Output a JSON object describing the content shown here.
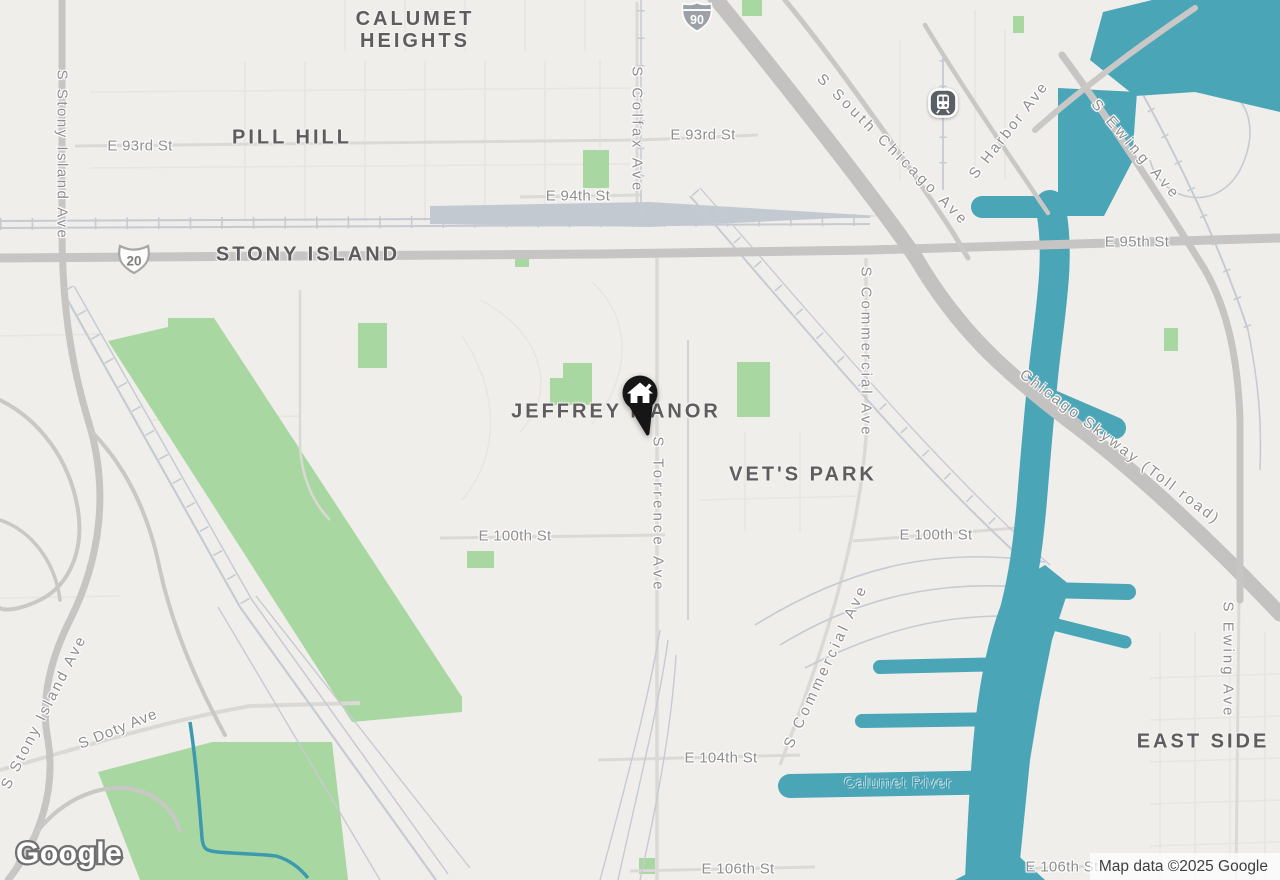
{
  "map": {
    "background_color": "#F0EEEB",
    "water_color": "#4AA5B7",
    "park_color": "#A9D7A2",
    "road_color": "#C6C5C3",
    "marker_color": "#161616"
  },
  "neighborhoods": {
    "calumet_heights_line1": "CALUMET",
    "calumet_heights_line2": "HEIGHTS",
    "pill_hill": "PILL HILL",
    "stony_island": "STONY ISLAND",
    "jeffrey_manor": "JEFFREY MANOR",
    "vets_park": "VET'S PARK",
    "east_side": "EAST SIDE"
  },
  "streets": {
    "e_93rd_west": "E 93rd St",
    "e_93rd_east": "E 93rd St",
    "e_94th": "E 94th St",
    "e_95th": "E 95th St",
    "e_100th_west": "E 100th St",
    "e_100th_east": "E 100th St",
    "e_104th": "E 104th St",
    "e_106th": "E 106th St",
    "e_106th_east": "E 106th St",
    "s_stony_island_north": "S Stony Island Ave",
    "s_stony_island_south": "S Stony Island Ave",
    "s_doty": "S Doty Ave",
    "s_colfax": "S Colfax Ave",
    "s_torrence": "S Torrence Ave",
    "s_commercial_north": "S Commercial Ave",
    "s_commercial_south": "S Commercial Ave",
    "s_south_chicago": "S South Chicago Ave",
    "s_harbor": "S Harbor Ave",
    "s_ewing_north": "S Ewing Ave",
    "s_ewing_south": "S Ewing Ave",
    "chicago_skyway": "Chicago Skyway (Toll road)"
  },
  "water_features": {
    "calumet_river": "Calumet River"
  },
  "route_shields": {
    "interstate_90": "90",
    "us_route_20": "20"
  },
  "branding": {
    "logo_text": "Google",
    "attribution_text": "Map data ©2025 Google"
  }
}
